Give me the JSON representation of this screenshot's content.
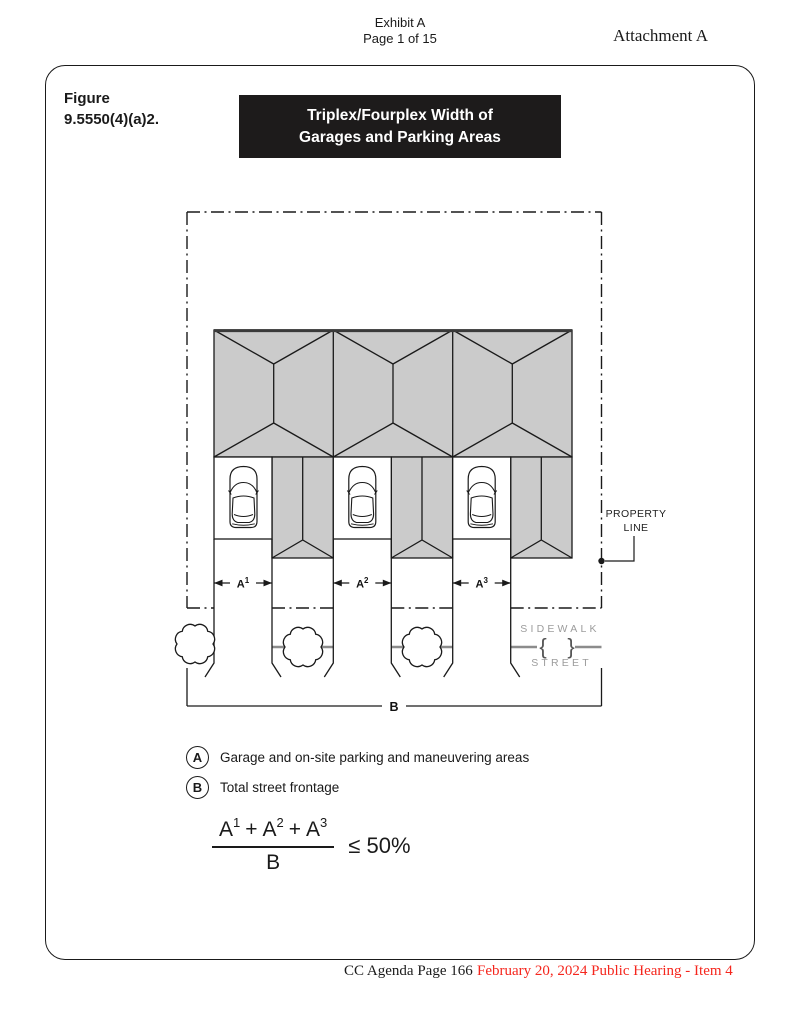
{
  "page_header": {
    "exhibit_line1": "Exhibit A",
    "exhibit_line2": "Page 1 of 15",
    "attachment": "Attachment A"
  },
  "figure": {
    "label_line1": "Figure",
    "label_line2": "9.5550(4)(a)2.",
    "title_line1": "Triplex/Fourplex Width of",
    "title_line2": "Garages and Parking Areas"
  },
  "diagram": {
    "property_line_label_line1": "PROPERTY",
    "property_line_label_line2": "LINE",
    "sidewalk_label": "SIDEWALK",
    "street_label": "STREET",
    "street_break_left": "{",
    "street_break_right": "}",
    "dimensions": [
      {
        "base": "A",
        "sup": "1"
      },
      {
        "base": "A",
        "sup": "2"
      },
      {
        "base": "A",
        "sup": "3"
      }
    ],
    "frontage_label": "B"
  },
  "legend": {
    "items": [
      {
        "symbol": "A",
        "text": "Garage and on-site parking and maneuvering areas"
      },
      {
        "symbol": "B",
        "text": "Total street frontage"
      }
    ]
  },
  "formula": {
    "numerator": [
      {
        "base": "A",
        "sup": "1"
      },
      {
        "base": "A",
        "sup": "2"
      },
      {
        "base": "A",
        "sup": "3"
      }
    ],
    "operator": "+",
    "denominator": "B",
    "comparison": "≤ 50%"
  },
  "page_footer": {
    "agenda": "CC Agenda Page 166",
    "hearing": "February 20, 2024 Public Hearing - Item 4"
  },
  "colors": {
    "banner_bg": "#1d1b1b",
    "banner_text": "#ffffff",
    "roof_fill": "#cbcbcb",
    "roof_eave": "#3a3a3a",
    "line_color": "#1a1a1a",
    "street_gray": "#8c8c8c",
    "muted_label": "#9c9c9c",
    "hearing_red": "#f5261d"
  }
}
